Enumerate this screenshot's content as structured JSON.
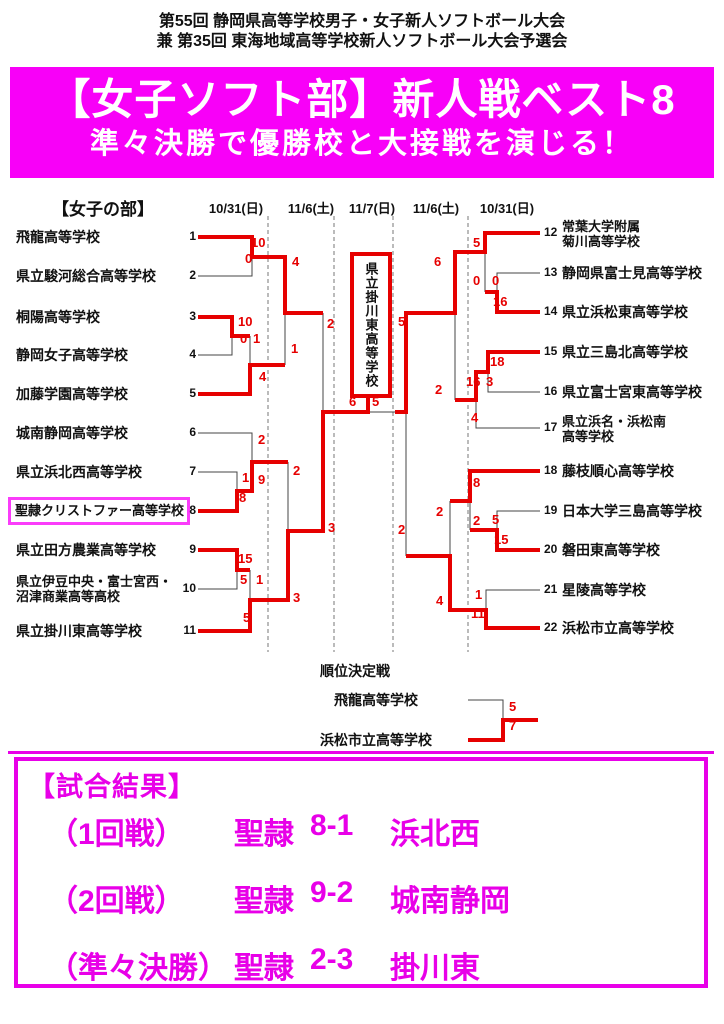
{
  "header": {
    "line1": "第55回 静岡県高等学校男子・女子新人ソフトボール大会",
    "line2": "兼 第35回 東海地域高等学校新人ソフトボール大会予選会"
  },
  "banner": {
    "title": "【女子ソフト部】新人戦ベスト8",
    "subtitle": "準々決勝で優勝校と大接戦を演じる！"
  },
  "colors": {
    "banner_magenta": "#f800f8",
    "results_magenta": "#e800e8",
    "winner_red": "#e60000"
  },
  "bracket": {
    "section_label": "【女子の部】",
    "dates": [
      "10/31(日)",
      "11/6(土)",
      "11/7(日)",
      "11/6(土)",
      "10/31(日)"
    ],
    "champion": "県立掛川東高等学校",
    "teams_left": [
      {
        "seed": "1",
        "lines": [
          "飛龍高等学校"
        ]
      },
      {
        "seed": "2",
        "lines": [
          "県立駿河総合高等学校"
        ]
      },
      {
        "seed": "3",
        "lines": [
          "桐陽高等学校"
        ]
      },
      {
        "seed": "4",
        "lines": [
          "静岡女子高等学校"
        ]
      },
      {
        "seed": "5",
        "lines": [
          "加藤学園高等学校"
        ]
      },
      {
        "seed": "6",
        "lines": [
          "城南静岡高等学校"
        ]
      },
      {
        "seed": "7",
        "lines": [
          "県立浜北西高等学校"
        ]
      },
      {
        "seed": "8",
        "lines": [
          "聖隷クリストファー高等学校"
        ]
      },
      {
        "seed": "9",
        "lines": [
          "県立田方農業高等学校"
        ]
      },
      {
        "seed": "10",
        "lines": [
          "県立伊豆中央・富士宮西・",
          "沼津商業高等高校"
        ]
      },
      {
        "seed": "11",
        "lines": [
          "県立掛川東高等学校"
        ]
      }
    ],
    "teams_right": [
      {
        "seed": "12",
        "lines": [
          "常葉大学附属",
          "菊川高等学校"
        ]
      },
      {
        "seed": "13",
        "lines": [
          "静岡県富士見高等学校"
        ]
      },
      {
        "seed": "14",
        "lines": [
          "県立浜松東高等学校"
        ]
      },
      {
        "seed": "15",
        "lines": [
          "県立三島北高等学校"
        ]
      },
      {
        "seed": "16",
        "lines": [
          "県立富士宮東高等学校"
        ]
      },
      {
        "seed": "17",
        "lines": [
          "県立浜名・浜松南",
          "高等学校"
        ]
      },
      {
        "seed": "18",
        "lines": [
          "藤枝順心高等学校"
        ]
      },
      {
        "seed": "19",
        "lines": [
          "日本大学三島高等学校"
        ]
      },
      {
        "seed": "20",
        "lines": [
          "磐田東高等学校"
        ]
      },
      {
        "seed": "21",
        "lines": [
          "星陵高等学校"
        ]
      },
      {
        "seed": "22",
        "lines": [
          "浜松市立高等学校"
        ]
      }
    ],
    "scores": [
      "10",
      "0",
      "4",
      "10",
      "0",
      "1",
      "1",
      "4",
      "2",
      "3",
      "2",
      "1",
      "9",
      "8",
      "2",
      "3",
      "15",
      "5",
      "1",
      "5",
      "6",
      "5",
      "5",
      "0",
      "0",
      "16",
      "6",
      "2",
      "5",
      "2",
      "18",
      "3",
      "16",
      "4",
      "8",
      "2",
      "5",
      "15",
      "2",
      "4",
      "1",
      "11"
    ]
  },
  "playoff": {
    "label": "順位決定戦",
    "team_top": "飛龍高等学校",
    "team_bottom": "浜松市立高等学校",
    "score_top": "5",
    "score_bottom": "7"
  },
  "results": {
    "title": "【試合結果】",
    "rows": [
      {
        "round": "（1回戦）",
        "team1": "聖隷",
        "score": "8-1",
        "team2": "浜北西"
      },
      {
        "round": "（2回戦）",
        "team1": "聖隷",
        "score": "9-2",
        "team2": "城南静岡"
      },
      {
        "round": "（準々決勝）",
        "team1": "聖隷",
        "score": "2-3",
        "team2": "掛川東"
      }
    ]
  }
}
